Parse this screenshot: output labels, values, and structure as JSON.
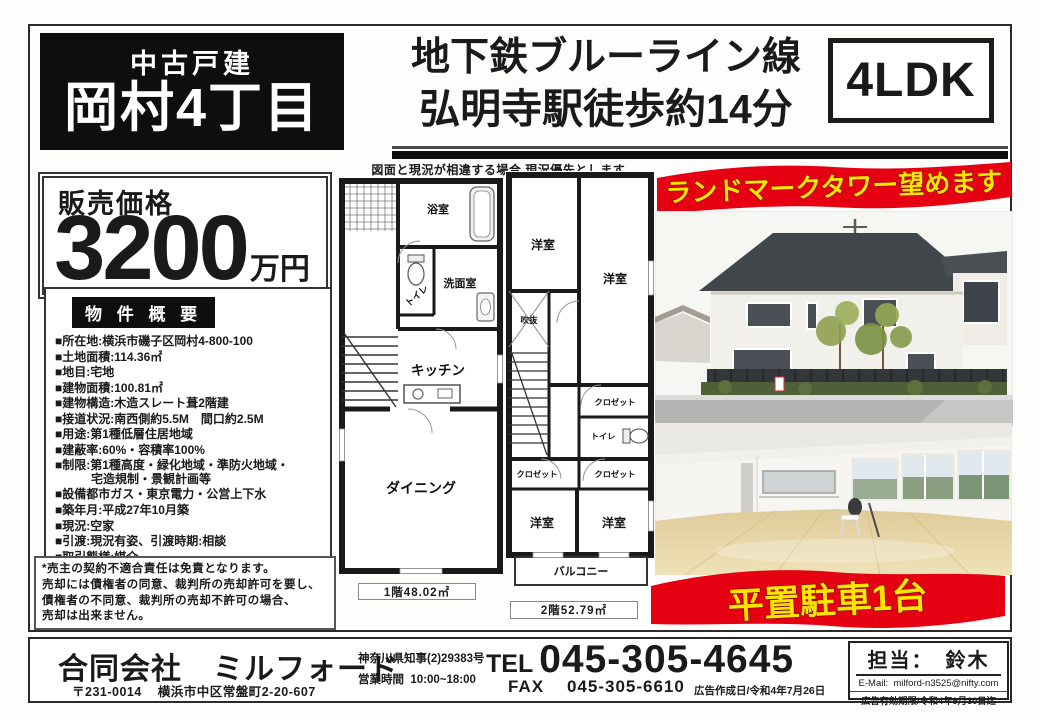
{
  "header": {
    "property_type": "中古戸建",
    "property_name": "岡村4丁目",
    "station_line1": "地下鉄ブルーライン線",
    "station_line2": "弘明寺駅徒歩約14分",
    "layout": "4LDK",
    "plan_disclaimer": "図面と現況が相違する場合,現況優先とします。"
  },
  "price": {
    "label": "販売価格",
    "amount": "3200",
    "unit": "万円"
  },
  "overview": {
    "title": "物 件 概 要",
    "items": [
      "■所在地:横浜市磯子区岡村4-800-100",
      "■土地面積:114.36㎡",
      "■地目:宅地",
      "■建物面積:100.81㎡",
      "■建物構造:木造スレート葺2階建",
      "■接道状況:南西側約5.5M　間口約2.5M",
      "■用途:第1種低層住居地域",
      "■建蔽率:60%・容積率100%",
      "■制限:第1種高度・緑化地域・準防火地域・\n　　　宅造規制・景観計画等",
      "■設備都市ガス・東京電力・公営上下水",
      "■築年月:平成27年10月築",
      "■現況:空家",
      "■引渡:現況有姿、引渡時期:相談",
      "■取引態様:媒介"
    ],
    "note": "*売主の契約不適合責任は免責となります。\n売却には債権者の同意、裁判所の売却許可を要し、\n債権者の不同意、裁判所の売却不許可の場合、\n売却は出来ません。"
  },
  "floorplan": {
    "floor1": {
      "bath": "浴室",
      "toilet": "トイレ",
      "washroom": "洗面室",
      "kitchen": "キッチン",
      "dining": "ダイニング",
      "area": "1階48.02㎡"
    },
    "floor2": {
      "room": "洋室",
      "void": "吹抜",
      "closet": "クロゼット",
      "toilet": "トイレ",
      "balcony": "バルコニー",
      "area": "2階52.79㎡"
    }
  },
  "banners": {
    "view": "ランドマークタワー望めます",
    "parking": "平置駐車1台",
    "red": "#e50012",
    "yellow": "#ffe400"
  },
  "footer": {
    "company": "合同会社　ミルフォード",
    "postal": "〒231-0014",
    "address": "横浜市中区常盤町2-20-607",
    "license": "神奈川県知事(2)29383号",
    "hours_label": "営業時間",
    "hours": "10:00~18:00",
    "tel_label": "TEL",
    "tel": "045-305-4645",
    "fax_label": "FAX",
    "fax": "045-305-6610",
    "ad_created": "広告作成日/令和4年7月26日",
    "staff": "担当：　鈴木",
    "email_label": "E-Mail:",
    "email": "milford-n3525@nifty.com",
    "ad_expiry": "広告有効期限/令和4年9月30日迄"
  }
}
